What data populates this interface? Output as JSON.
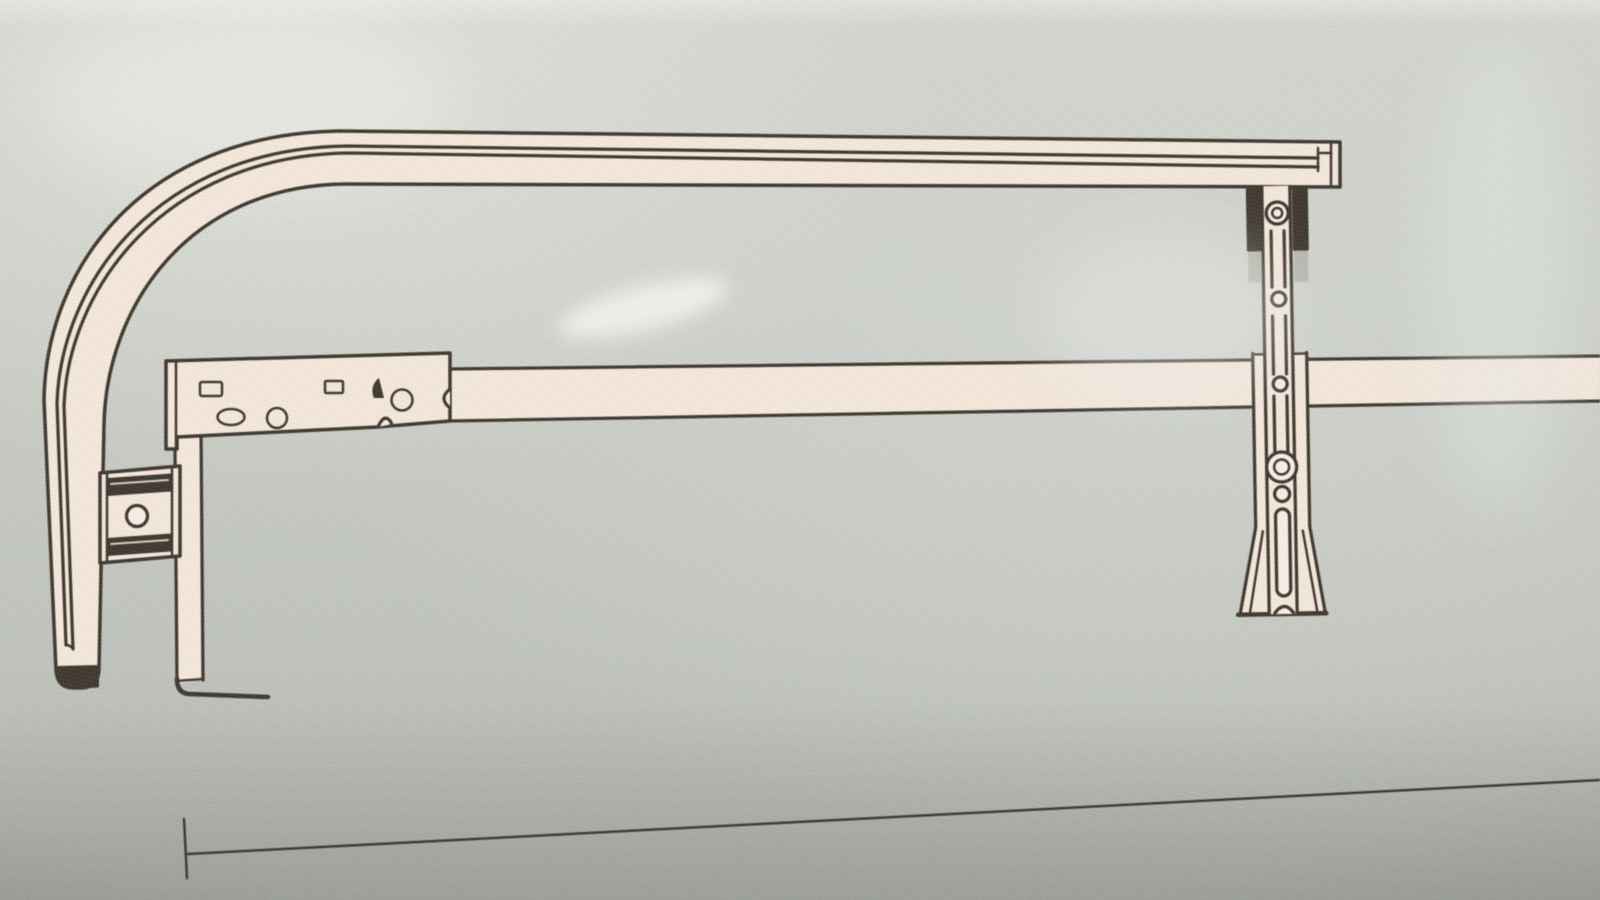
{
  "document": {
    "kind": "photographed instruction-manual line drawing",
    "visible_text": "",
    "subject": "rail and support-bracket assembly, side view"
  },
  "colors": {
    "paper-light": "#dfe1da",
    "paper-mid": "#c8ccc5",
    "paper-dark": "#b2b6af",
    "ink": "#3d362c",
    "fill-cream": "#f5e8dd",
    "fill-cream-light": "#f8eee5",
    "metal-gray": "#a49f95"
  },
  "parts": [
    {
      "id": "curved-rail",
      "label": "long top rail curving 90 degrees down at left into a floor tube with dark end cap"
    },
    {
      "id": "crossbar",
      "label": "horizontal middle bar running to right edge"
    },
    {
      "id": "mounting-plate",
      "label": "stamped plate on left end of crossbar with rectangular, oval, round and wedge cutouts plus edge notches"
    },
    {
      "id": "support-leg",
      "label": "vertical leg strip with L-shaped floor foot"
    },
    {
      "id": "tube-clamp",
      "label": "clamp block joining the curved tube to the leg, two dark slots and a center hole"
    },
    {
      "id": "support-bracket",
      "label": "vertical adjustable bracket under rail: dark clamp pads, bolt heads, dashed slot, holes, long slot, flared feet"
    },
    {
      "id": "baseline",
      "label": "thin dimension baseline with left end tick"
    }
  ]
}
